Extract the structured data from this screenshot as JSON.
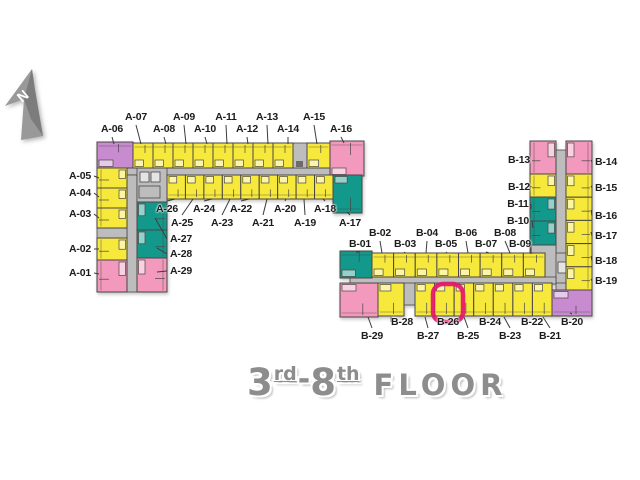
{
  "north": {
    "label": "N"
  },
  "title": {
    "from_floor": "3",
    "from_suffix": "rd",
    "separator": "-",
    "to_floor": "8",
    "to_suffix": "th",
    "word": "FLOOR"
  },
  "highlight": {
    "selected_unit": "B-26"
  },
  "building_a": {
    "name": "A",
    "unit_labels": [
      "A-01",
      "A-02",
      "A-03",
      "A-04",
      "A-05",
      "A-06",
      "A-07",
      "A-08",
      "A-09",
      "A-10",
      "A-11",
      "A-12",
      "A-13",
      "A-14",
      "A-15",
      "A-16",
      "A-17",
      "A-18",
      "A-19",
      "A-20",
      "A-21",
      "A-22",
      "A-23",
      "A-24",
      "A-25",
      "A-26",
      "A-27",
      "A-28",
      "A-29"
    ]
  },
  "building_b": {
    "name": "B",
    "unit_labels": [
      "B-01",
      "B-02",
      "B-03",
      "B-04",
      "B-05",
      "B-06",
      "B-07",
      "B-08",
      "B-09",
      "B-10",
      "B-11",
      "B-12",
      "B-13",
      "B-14",
      "B-15",
      "B-16",
      "B-17",
      "B-18",
      "B-19",
      "B-20",
      "B-21",
      "B-22",
      "B-23",
      "B-24",
      "B-25",
      "B-26",
      "B-27",
      "B-28",
      "B-29"
    ]
  },
  "colors": {
    "yellow": "#f6e93b",
    "pink": "#f399bd",
    "purple": "#c88bd0",
    "teal": "#12998c",
    "core_gray": "#bdbdbd",
    "corridor_gray": "#b3b3b3",
    "elevator_light": "#e4e4e4",
    "wall": "#4a4545",
    "leader": "#3c3c3c",
    "highlight_ring": "#e4156e",
    "title_gray": "#8d8d8d",
    "north_gray": "#999999",
    "north_gray_dark": "#7c7c7c"
  }
}
